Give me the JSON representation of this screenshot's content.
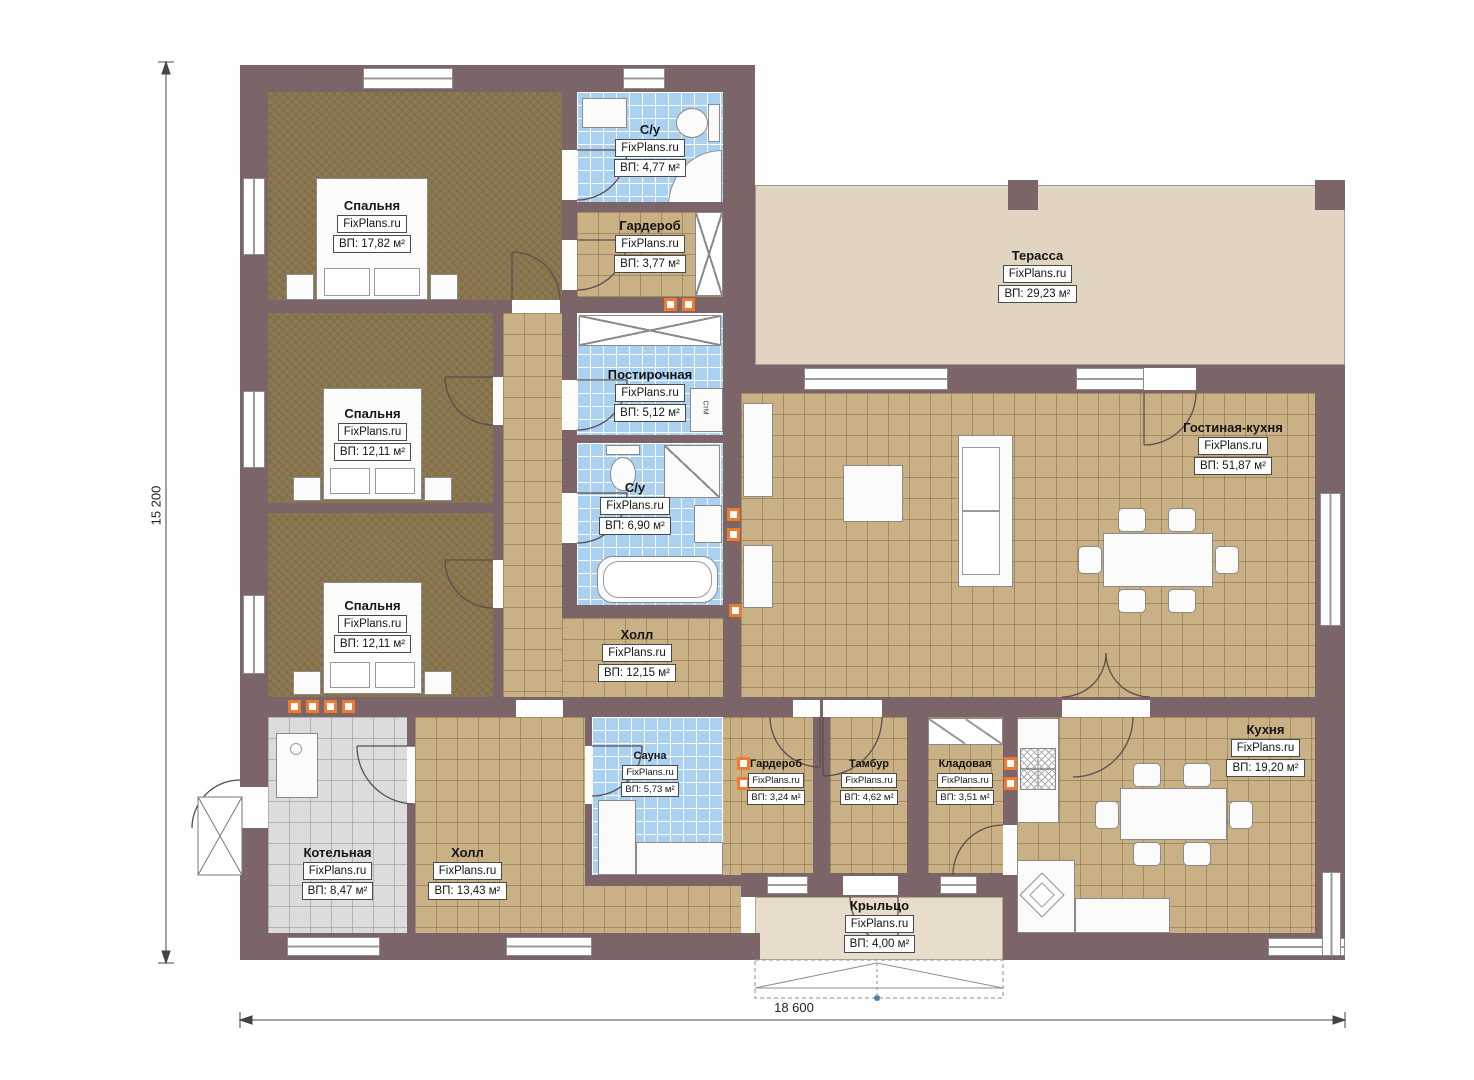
{
  "watermark": "FixPlans.ru",
  "dimensions": {
    "bottom": "18 600",
    "left": "15 200"
  },
  "palette": {
    "wall": "#7b6569",
    "tile_tan": "#c9b185",
    "tile_blue": "#abd1f1",
    "tile_grey": "#dcdcdc",
    "carpet": "#8d7a52",
    "terrace": "#e1d5c1",
    "vent_orange": "#ef7b30"
  },
  "rooms": {
    "bedroom1": {
      "name": "Спальня",
      "area": "ВП: 17,82 м²"
    },
    "bathroom1": {
      "name": "С/у",
      "area": "ВП: 4,77 м²"
    },
    "wardrobe1": {
      "name": "Гардероб",
      "area": "ВП: 3,77 м²"
    },
    "bedroom2": {
      "name": "Спальня",
      "area": "ВП: 12,11 м²"
    },
    "laundry": {
      "name": "Постирочная",
      "area": "ВП: 5,12 м²"
    },
    "bathroom2": {
      "name": "С/у",
      "area": "ВП: 6,90 м²"
    },
    "bedroom3": {
      "name": "Спальня",
      "area": "ВП: 12,11 м²"
    },
    "hall1": {
      "name": "Холл",
      "area": "ВП: 12,15 м²"
    },
    "terrace": {
      "name": "Терасса",
      "area": "ВП: 29,23 м²"
    },
    "living": {
      "name": "Гостиная-кухня",
      "area": "ВП: 51,87 м²"
    },
    "boiler": {
      "name": "Котельная",
      "area": "ВП: 8,47 м²"
    },
    "hall2": {
      "name": "Холл",
      "area": "ВП: 13,43 м²"
    },
    "sauna": {
      "name": "Сауна",
      "area": "ВП: 5,73 м²"
    },
    "wardrobe2": {
      "name": "Гардероб",
      "area": "ВП: 3,24 м²"
    },
    "tambour": {
      "name": "Тамбур",
      "area": "ВП: 4,62 м²"
    },
    "storage": {
      "name": "Кладовая",
      "area": "ВП: 3,51 м²"
    },
    "kitchen": {
      "name": "Кухня",
      "area": "ВП: 19,20 м²"
    },
    "porch": {
      "name": "Крыльцо",
      "area": "ВП: 4,00 м²"
    }
  },
  "appliances": {
    "washing_machine": "СтМ"
  }
}
